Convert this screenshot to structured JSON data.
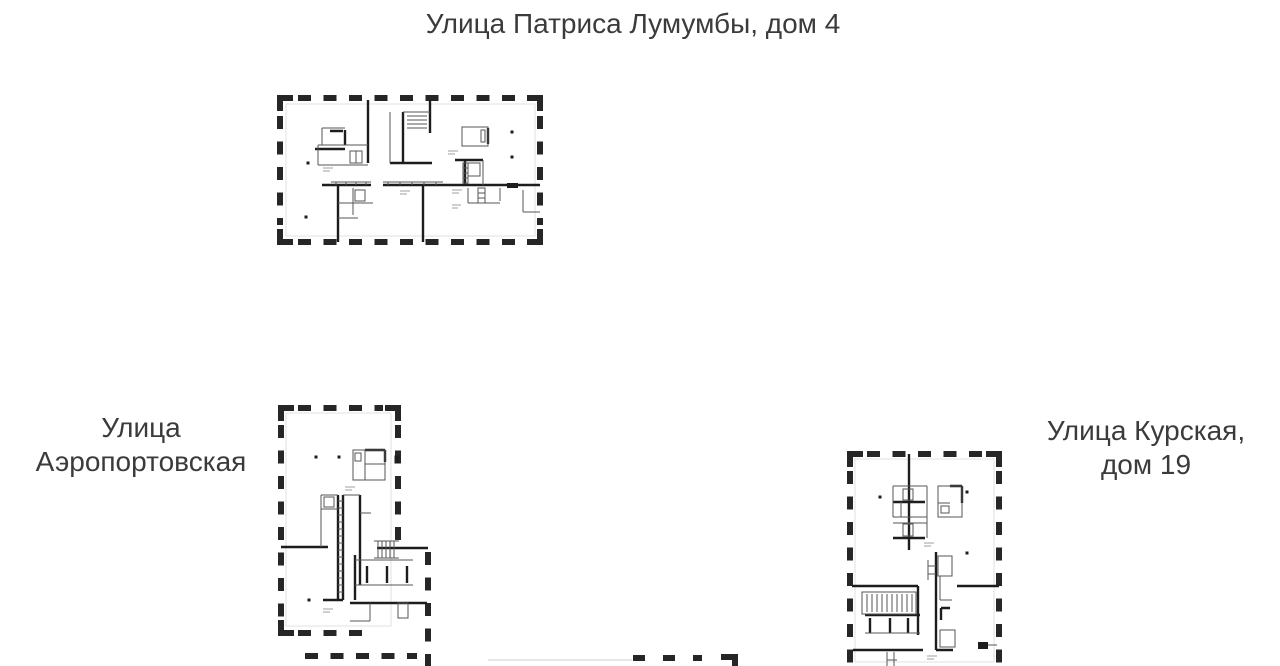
{
  "page": {
    "background": "#ffffff",
    "text_color": "#3b3b3b",
    "wall_color": "#1d1d1d",
    "dash_color": "#262626"
  },
  "labels": {
    "building_top": {
      "text": "Улица Патриса Лумумбы, дом 4"
    },
    "building_left": {
      "line1": "Улица",
      "line2": "Аэропортовская"
    },
    "building_right": {
      "line1": "Улица Курская,",
      "line2": "дом 19"
    }
  }
}
